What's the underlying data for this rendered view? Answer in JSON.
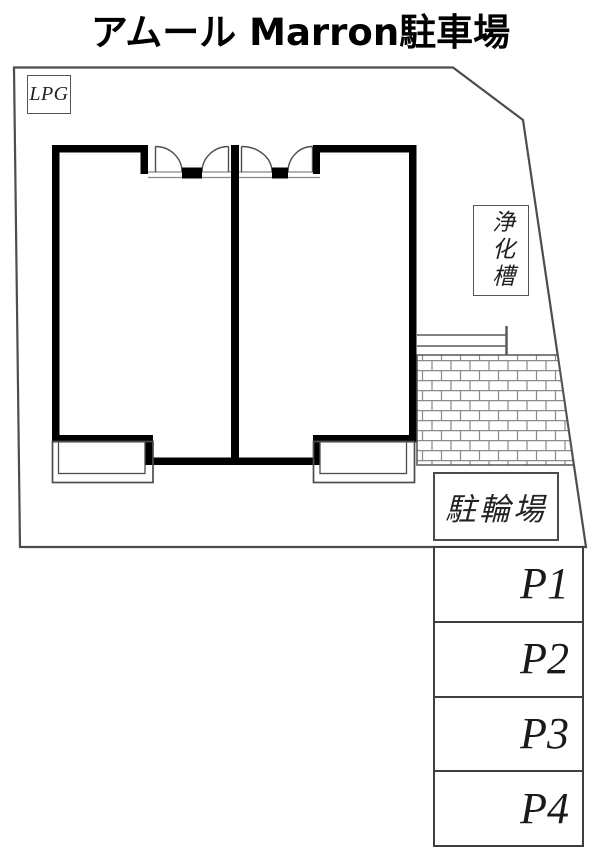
{
  "title": "アムール Marron駐車場",
  "site": {
    "lpg_label": "LPG",
    "septic_tank_label": "浄化槽",
    "bicycle_parking_label": "駐輪場"
  },
  "parking": {
    "spaces": [
      {
        "label": "P1"
      },
      {
        "label": "P2"
      },
      {
        "label": "P3"
      },
      {
        "label": "P4"
      }
    ]
  },
  "colors": {
    "wall": "#000000",
    "boundary_line": "#4d4d4d",
    "thin_line": "#888888",
    "background": "#ffffff"
  }
}
